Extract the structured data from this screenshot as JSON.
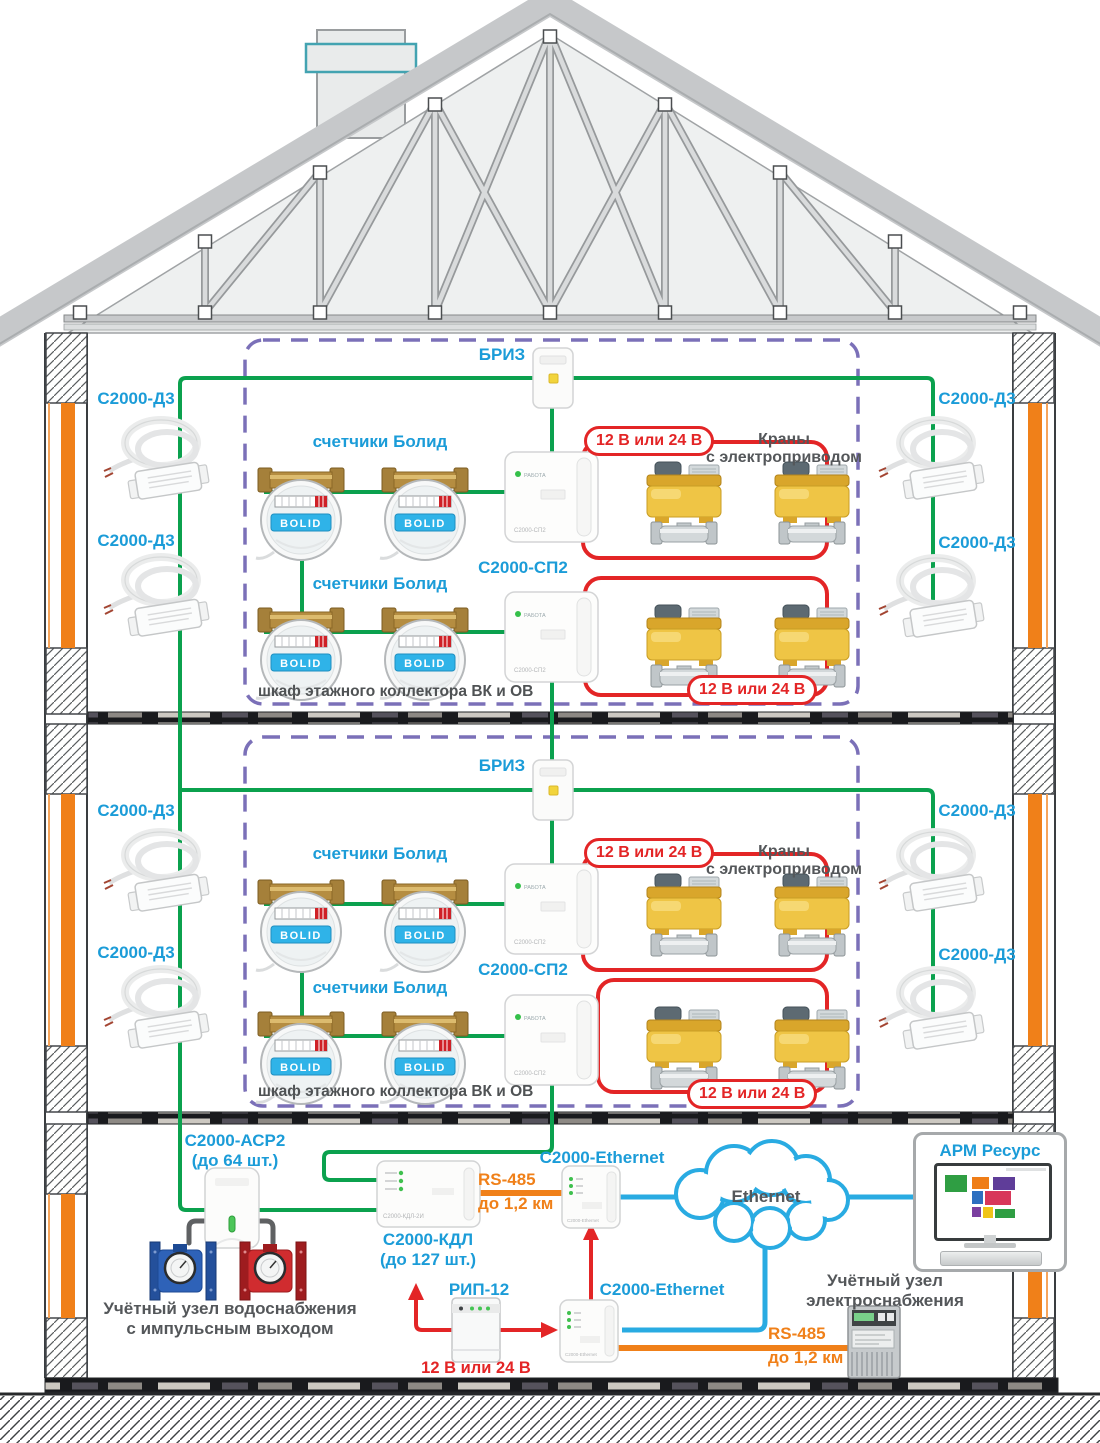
{
  "labels": {
    "breeze": "БРИЗ",
    "d3": "С2000-Д3",
    "meters": "счетчики Болид",
    "sp2": "С2000-СП2",
    "power": "12 В или 24 В",
    "valves_line1": "Краны",
    "valves_line2": "с электроприводом",
    "cabinet": "шкаф этажного коллектора ВК и ОВ",
    "asr2_line1": "С2000-АСР2",
    "asr2_line2": "(до 64 шт.)",
    "kdl_line1": "С2000-КДЛ",
    "kdl_line2": "(до 127 шт.)",
    "rs485": "RS-485",
    "rs485_distance": "до 1,2 км",
    "ethernet_device": "C2000-Ethernet",
    "ethernet_cloud": "Ethernet",
    "rip": "РИП-12",
    "arm": "АРМ Ресурс",
    "water_unit_line1": "Учётный узел водоснабжения",
    "water_unit_line2": "с импульсным выходом",
    "power_unit_line1": "Учётный узел",
    "power_unit_line2": "электроснабжения"
  },
  "device_text": {
    "sp2_led": "РАБОТА",
    "sp2_model": "С2000-СП2",
    "bolid_logo": "BOLID",
    "kdl_model": "С2000-КДЛ-2И"
  },
  "colors": {
    "label_blue": "#1b9cd8",
    "wire_green": "#0ba14e",
    "wire_red": "#e32526",
    "wire_orange": "#f08019",
    "wire_blue": "#29abe2",
    "dashed_cabinet": "#7b70b8",
    "text_dark": "#54575a",
    "valve_yellow": "#efc545",
    "riser_orange": "#f08019"
  },
  "arm_screen_tiles": [
    "#2f9e43",
    "#ef7d17",
    "#5f3d99",
    "#2d6fc0",
    "#d8375a",
    "#7b3fa0",
    "#f0c419",
    "#2f9e43"
  ]
}
